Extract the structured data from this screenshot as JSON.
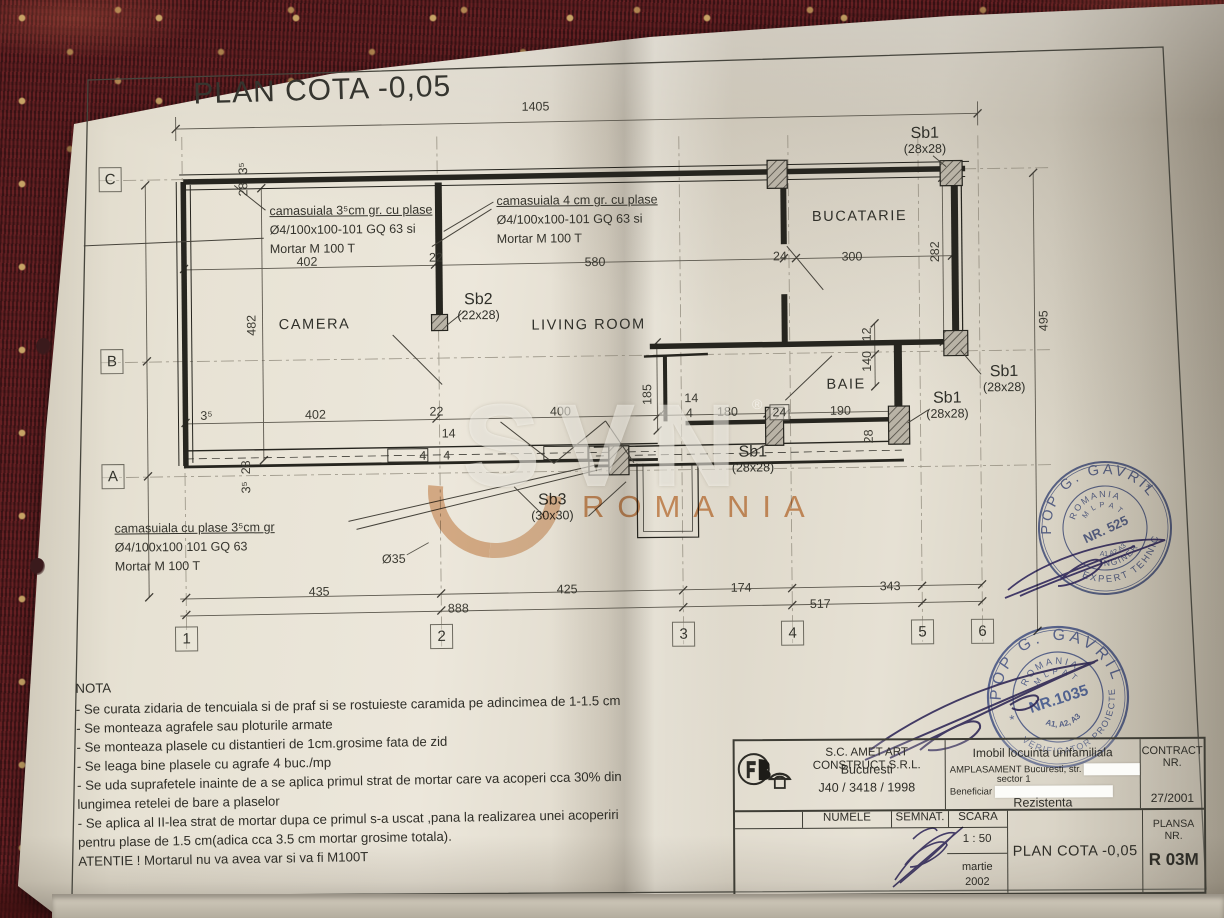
{
  "page": {
    "title": "PLAN COTA -0,05"
  },
  "watermark": {
    "letters": "SVN",
    "reg": "®",
    "romania": "ROMANIA"
  },
  "rooms": [
    {
      "label": "CAMERA",
      "x": 320,
      "y": 327
    },
    {
      "label": "LIVING ROOM",
      "x": 594,
      "y": 330
    },
    {
      "label": "BUCATARIE",
      "x": 866,
      "y": 224
    },
    {
      "label": "BAIE",
      "x": 851,
      "y": 392
    }
  ],
  "column_labels": [
    {
      "name": "Sb1",
      "size": "(28x28)",
      "x": 932,
      "y": 133
    },
    {
      "name": "Sb2",
      "size": "(22x28)",
      "x": 484,
      "y": 295
    },
    {
      "name": "Sb1",
      "size": "(28x28)",
      "x": 1009,
      "y": 372
    },
    {
      "name": "Sb1",
      "size": "(28x28)",
      "x": 952,
      "y": 398
    },
    {
      "name": "Sb1",
      "size": "(28x28)",
      "x": 757,
      "y": 450
    },
    {
      "name": "Sb3",
      "size": "(30x30)",
      "x": 556,
      "y": 496
    }
  ],
  "annotations": [
    {
      "x": 276,
      "y": 204,
      "lines": [
        "camasuiala  3⁵cm gr. cu plase",
        "Ø4/100x100-101 GQ 63 si",
        "Mortar M 100 T"
      ]
    },
    {
      "x": 503,
      "y": 196,
      "lines": [
        "camasuiala  4 cm gr. cu plase",
        "Ø4/100x100-101 GQ 63 si",
        "Mortar M 100 T"
      ]
    },
    {
      "x": 118,
      "y": 520,
      "lines": [
        "camasuiala cu plase 3⁵cm gr",
        "Ø4/100x100 101 GQ 63",
        "Mortar M 100 T"
      ]
    }
  ],
  "dimensions": [
    {
      "t": "1405",
      "x": 543,
      "y": 111
    },
    {
      "t": "3⁵",
      "x": 250,
      "y": 170,
      "v": true
    },
    {
      "t": "28",
      "x": 250,
      "y": 191,
      "v": true
    },
    {
      "t": "402",
      "x": 313,
      "y": 264
    },
    {
      "t": "22",
      "x": 442,
      "y": 261
    },
    {
      "t": "580",
      "x": 601,
      "y": 267
    },
    {
      "t": "24",
      "x": 786,
      "y": 263
    },
    {
      "t": "300",
      "x": 858,
      "y": 264
    },
    {
      "t": "282",
      "x": 941,
      "y": 260,
      "v": true
    },
    {
      "t": "482",
      "x": 257,
      "y": 327,
      "v": true
    },
    {
      "t": "495",
      "x": 1049,
      "y": 330,
      "v": true
    },
    {
      "t": "12",
      "x": 872,
      "y": 342,
      "v": true
    },
    {
      "t": "140",
      "x": 872,
      "y": 369,
      "v": true
    },
    {
      "t": "185",
      "x": 652,
      "y": 400,
      "v": true
    },
    {
      "t": "14",
      "x": 696,
      "y": 404
    },
    {
      "t": "4",
      "x": 668,
      "y": 419
    },
    {
      "t": "4",
      "x": 694,
      "y": 419
    },
    {
      "t": "180",
      "x": 732,
      "y": 418
    },
    {
      "t": "24",
      "x": 784,
      "y": 419,
      "boxed": true
    },
    {
      "t": "190",
      "x": 845,
      "y": 418
    },
    {
      "t": "28",
      "x": 873,
      "y": 444,
      "v": true
    },
    {
      "t": "3⁵",
      "x": 211,
      "y": 417
    },
    {
      "t": "402",
      "x": 320,
      "y": 417
    },
    {
      "t": "22",
      "x": 441,
      "y": 415
    },
    {
      "t": "400",
      "x": 565,
      "y": 416
    },
    {
      "t": "14",
      "x": 453,
      "y": 437
    },
    {
      "t": "4",
      "x": 427,
      "y": 459
    },
    {
      "t": "4",
      "x": 451,
      "y": 459
    },
    {
      "t": "28",
      "x": 250,
      "y": 469,
      "v": true
    },
    {
      "t": "3⁵",
      "x": 250,
      "y": 489,
      "v": true
    },
    {
      "t": "Ø35",
      "x": 397,
      "y": 562
    },
    {
      "t": "435",
      "x": 322,
      "y": 594
    },
    {
      "t": "425",
      "x": 570,
      "y": 594
    },
    {
      "t": "174",
      "x": 744,
      "y": 594
    },
    {
      "t": "343",
      "x": 893,
      "y": 594
    },
    {
      "t": "888",
      "x": 461,
      "y": 612
    },
    {
      "t": "517",
      "x": 823,
      "y": 611
    }
  ],
  "grid": {
    "col_y": 640,
    "row_x": 117,
    "cols": [
      {
        "label": "1",
        "x": 189
      },
      {
        "label": "2",
        "x": 444
      },
      {
        "label": "3",
        "x": 686
      },
      {
        "label": "4",
        "x": 795
      },
      {
        "label": "5",
        "x": 925
      },
      {
        "label": "6",
        "x": 985
      }
    ],
    "rows": [
      {
        "label": "C",
        "y": 180
      },
      {
        "label": "B",
        "y": 362
      },
      {
        "label": "A",
        "y": 477
      }
    ]
  },
  "nota": {
    "heading": "NOTA",
    "lines": [
      "- Se curata zidaria de tencuiala si de praf si se rostuieste caramida pe adincimea de 1-1.5 cm",
      "- Se monteaza agrafele sau ploturile armate",
      "- Se monteaza plasele cu distantieri de 1cm.grosime fata de zid",
      "- Se leaga bine plasele cu agrafe  4 buc./mp",
      "- Se uda suprafetele inainte de  a se aplica primul strat de mortar care va acoperi cca 30% din",
      "lungimea retelei de bare a plaselor",
      "- Se aplica al II-lea strat de mortar dupa ce primul s-a uscat ,pana la realizarea unei acoperiri",
      "pentru plase de 1.5 cm(adica cca 3.5 cm mortar grosime totala).",
      "ATENTIE ! Mortarul  nu va avea var si va fi M100T"
    ]
  },
  "title_block": {
    "company": {
      "name": "S.C. AMET ART CONSTRUCT S.R.L.",
      "city": "Bucuresti",
      "reg": "J40 / 3418 / 1998"
    },
    "project": {
      "title": "Imobil locuinta unifamiliala",
      "amplasament": "AMPLASAMENT Bucuresti, str.",
      "sector": "sector 1",
      "beneficiar_label": "Beneficiar",
      "discipline": "Rezistenta"
    },
    "contract": {
      "label1": "CONTRACT",
      "label2": "NR.",
      "number": "27/2001"
    },
    "table": {
      "headers": {
        "numele": "NUMELE",
        "semnat": "SEMNAT.",
        "scara": "SCARA"
      },
      "rows": [
        {
          "role": "PROIECTAT",
          "name": "sing. V. Onutu"
        },
        {
          "role": "DESENAT",
          "name": "th. D. Onutu"
        },
        {
          "role": "VERIFICAT",
          "name": "ing. L. Onutu"
        },
        {
          "role": "APROBAT",
          "name": "arh. Isan. AMET"
        }
      ]
    },
    "scale": "1 : 50",
    "date": "martie\n2002",
    "plan_title": "PLAN COTA  -0,05",
    "plansa_label": "PLANSA\nNR.",
    "plansa": "R 03M"
  },
  "stamps": {
    "expert": {
      "name": "POP G. GAVRIL",
      "star": "*",
      "country": "ROMANIA",
      "org": "M L P A T",
      "nr": "NR. 525",
      "grades": "A1.A2.A3",
      "role_inner": "INGINER",
      "role_outer": "EXPERT TEHNIC"
    },
    "verificator": {
      "name": "POP G. GAVRIL",
      "star": "*",
      "country": "ROMANIA",
      "org": "M L P A T",
      "nr": "NR.1035",
      "grades": "A1, A2, A3",
      "role_outer": "VERIFICATOR PROIECTE"
    }
  }
}
